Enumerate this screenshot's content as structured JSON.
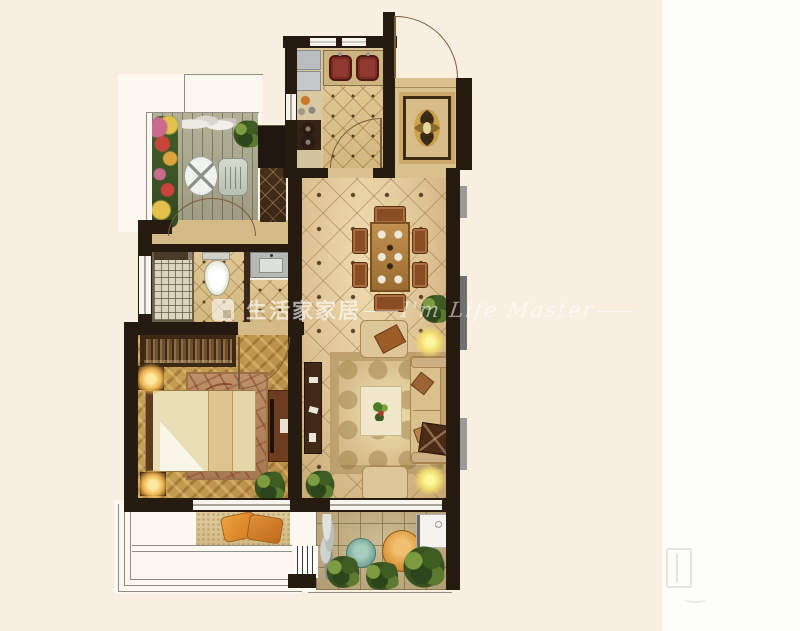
{
  "scene_type": "residential floor plan rendering",
  "watermark": {
    "brand_text": "生活家家居",
    "separator_left": "—",
    "script_text": "I'm Life Master",
    "separator_right": "—"
  },
  "icons": {
    "watermark_logo": "brand-square-logo",
    "corner_logo": "faint-brand-mark"
  },
  "colors": {
    "background_left": "#f8efe0",
    "background_right": "#fdfdfc",
    "wall": "#261b10",
    "tile_floor": "#ddc293",
    "kitchen_tile": "#d9c08c",
    "wood_floor": "#c29a50",
    "deck": "#afac92",
    "rug_living": "#d8c08e",
    "rug_bedroom": "#b08760",
    "sofa_beige": "#d9c08c",
    "accent_orange": "#e0913a",
    "accent_teal": "#7fae9f",
    "plant_green": "#3f5c22",
    "sink_red": "#8e3a30",
    "watermark_white": "rgba(255,255,255,0.6)"
  }
}
